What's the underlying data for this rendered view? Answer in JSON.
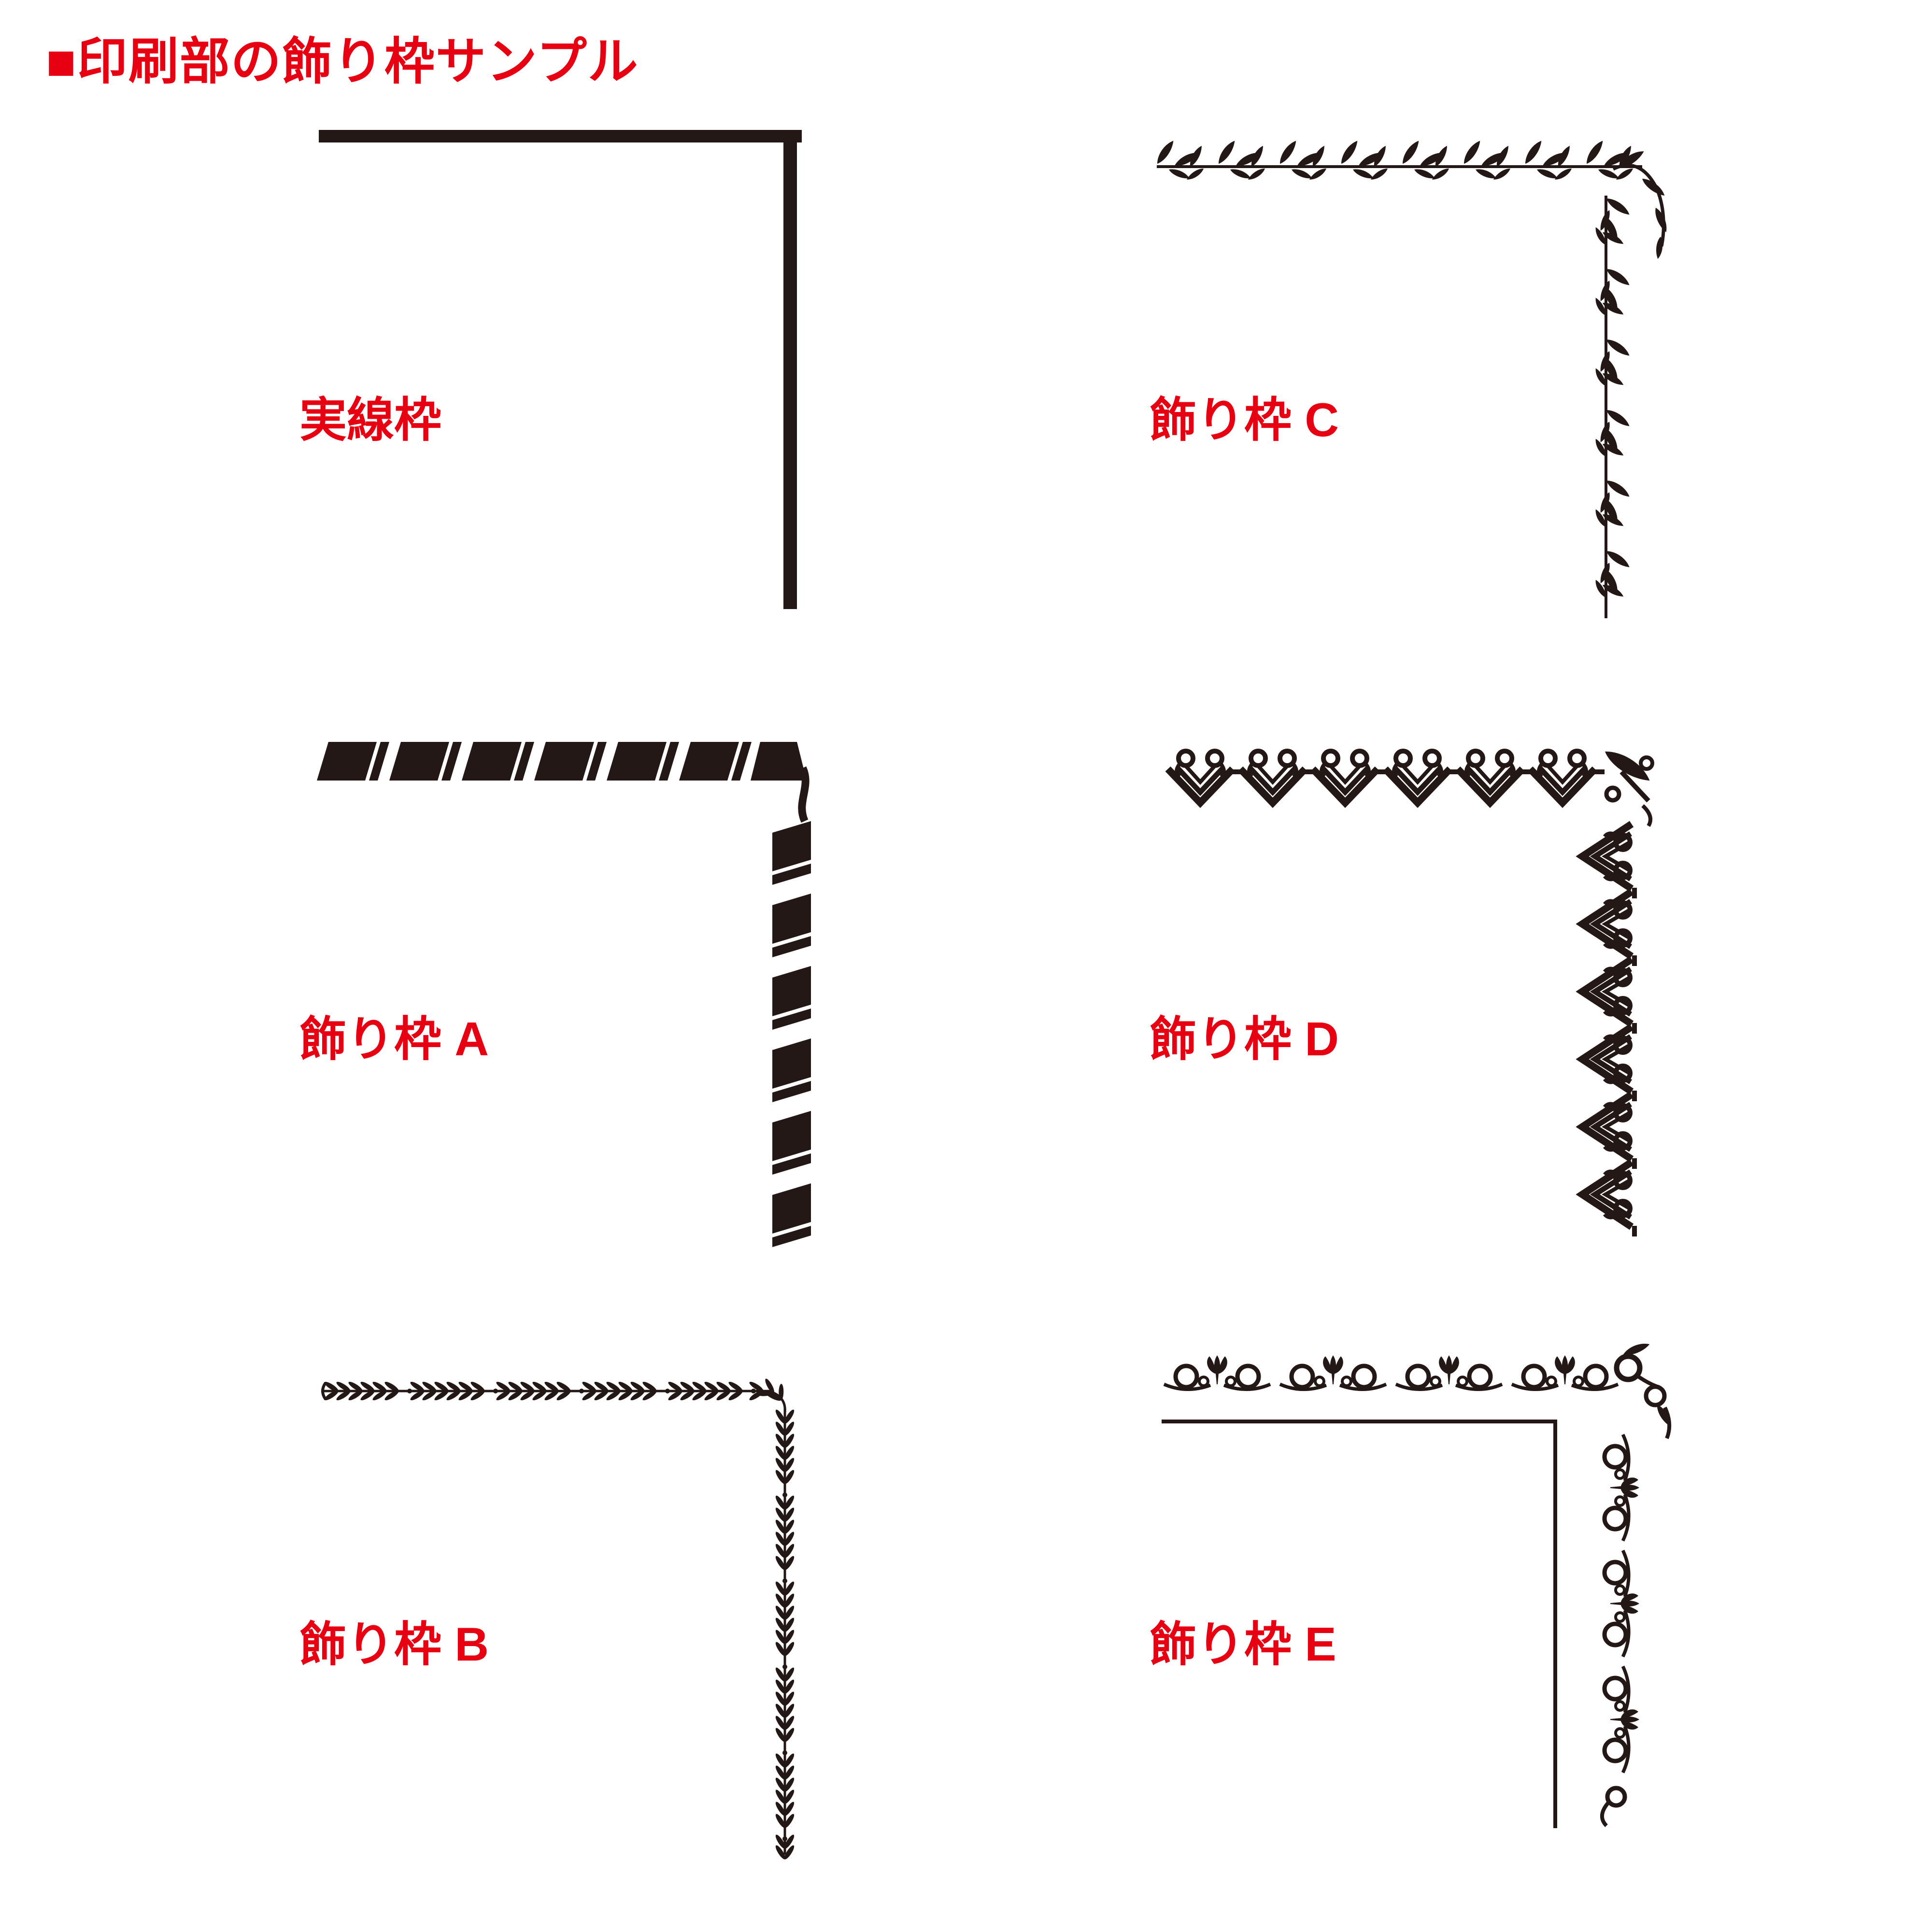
{
  "header": {
    "title": "■印刷部の飾り枠サンプル"
  },
  "colors": {
    "accent_red": "#e60012",
    "ink_black": "#231815",
    "background": "#ffffff"
  },
  "samples": [
    {
      "id": "solid-frame",
      "label": "実線枠",
      "graphic": "solid-line-corner-border"
    },
    {
      "id": "frame-c",
      "label": "飾り枠 C",
      "graphic": "leaf-vine-corner-border"
    },
    {
      "id": "frame-a",
      "label": "飾り枠 A",
      "graphic": "twisted-ribbon-corner-border"
    },
    {
      "id": "frame-d",
      "label": "飾り枠 D",
      "graphic": "scroll-heart-corner-border"
    },
    {
      "id": "frame-b",
      "label": "飾り枠 B",
      "graphic": "laurel-chevron-corner-border"
    },
    {
      "id": "frame-e",
      "label": "飾り枠 E",
      "graphic": "tulip-scroll-corner-border"
    }
  ]
}
